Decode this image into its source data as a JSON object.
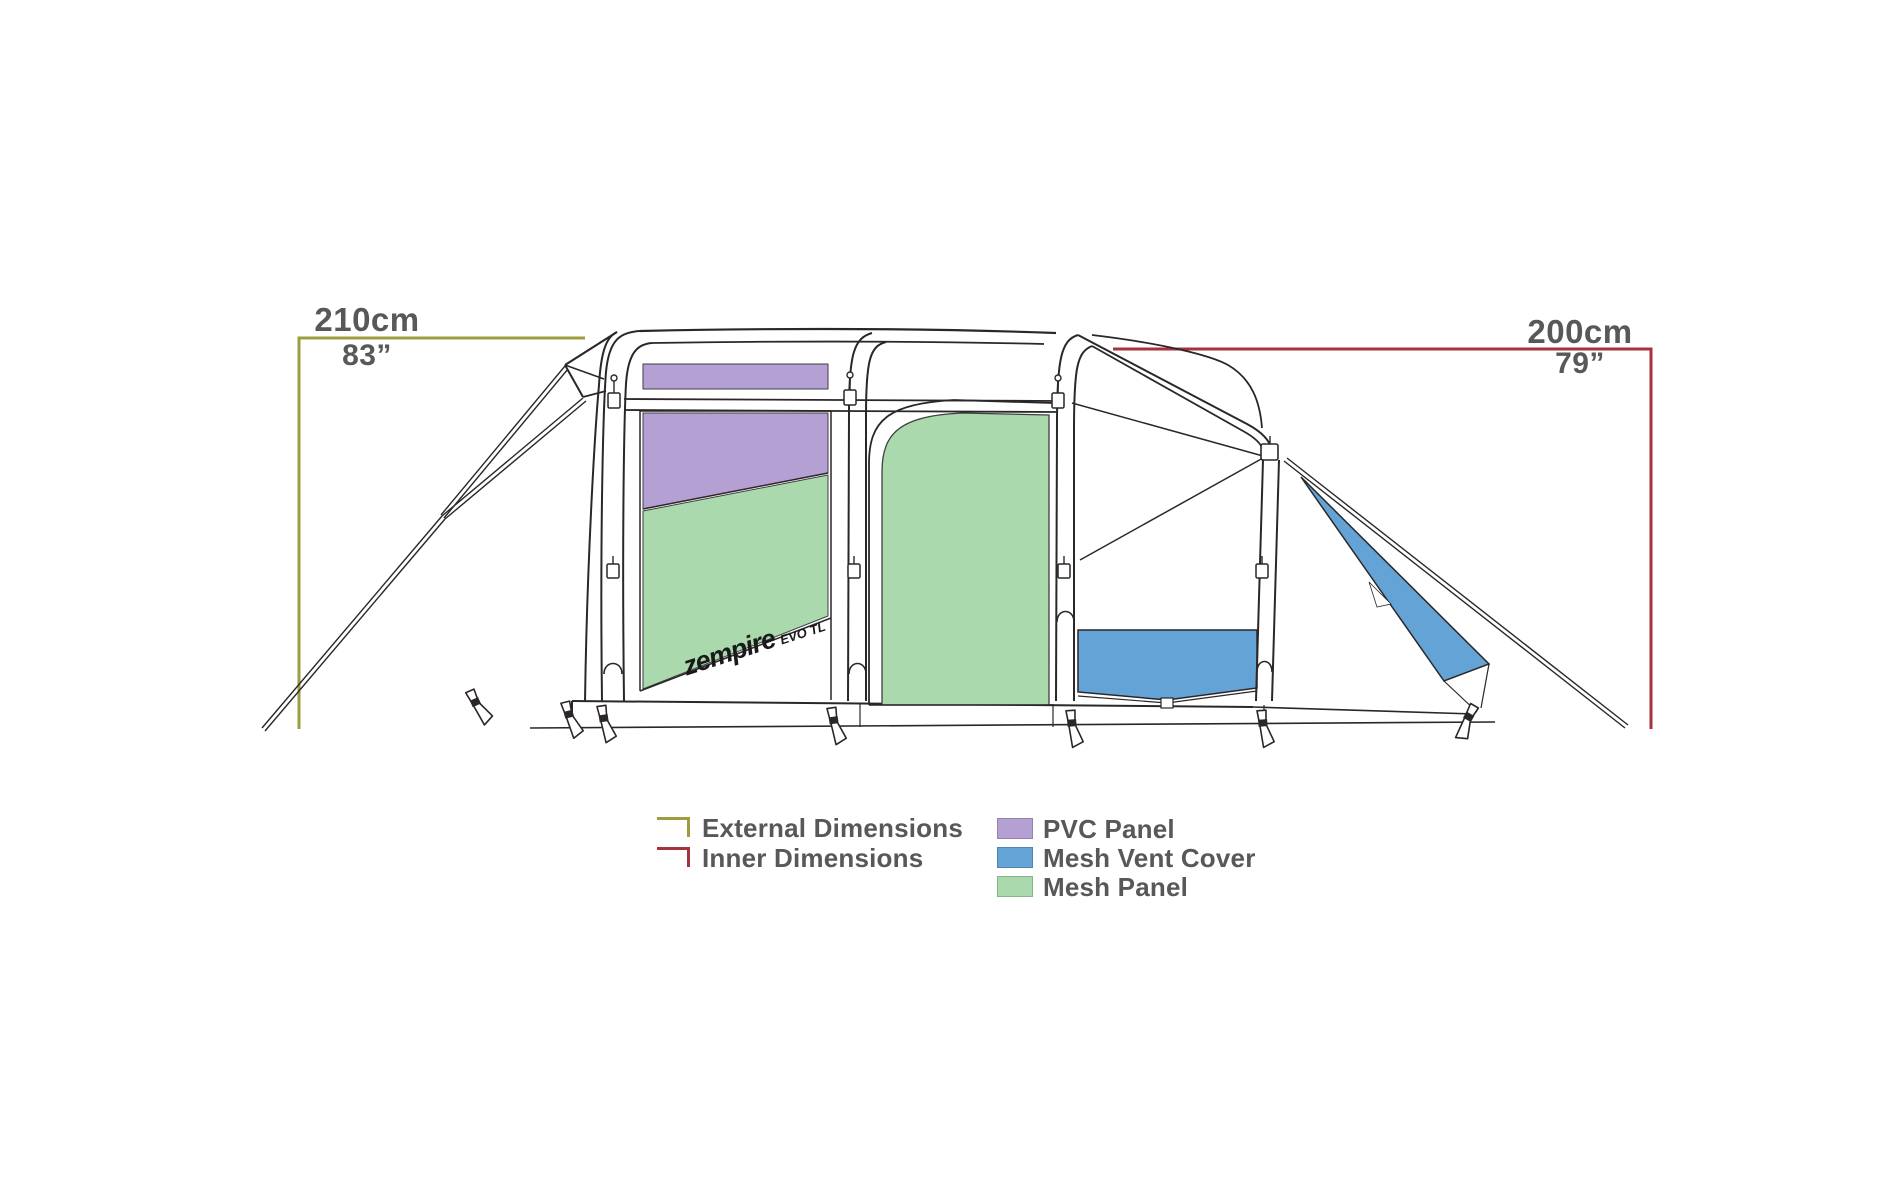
{
  "diagram_title": "Tent side elevation with dimensions",
  "dimensions": {
    "external": {
      "value_cm": "210cm",
      "value_in": "83”",
      "color": "#9d9d3f"
    },
    "inner": {
      "value_cm": "200cm",
      "value_in": "79”",
      "color": "#a63240"
    }
  },
  "legend": {
    "line_items": [
      {
        "label": "External Dimensions",
        "color": "#9d9d3f"
      },
      {
        "label": "Inner Dimensions",
        "color": "#a63240"
      }
    ],
    "panel_items": [
      {
        "label": "PVC Panel",
        "color": "#b5a0d3"
      },
      {
        "label": "Mesh Vent Cover",
        "color": "#63a3d5"
      },
      {
        "label": "Mesh Panel",
        "color": "#a9d9ad"
      }
    ]
  },
  "logo": {
    "brand": "zempire",
    "model": "EVO TL"
  },
  "colors": {
    "pvc_panel": "#b5a0d3",
    "mesh_vent_cover": "#63a3d5",
    "mesh_panel": "#a9d9ad",
    "external_dimension_line": "#9d9d3f",
    "inner_dimension_line": "#a63240",
    "outline": "#2b2728",
    "label_text": "#57585a"
  }
}
